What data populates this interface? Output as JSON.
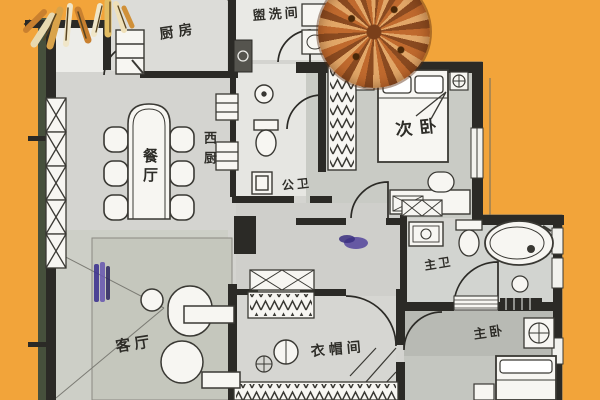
{
  "meta": {
    "type": "hand-drawn apartment floor plan"
  },
  "colors": {
    "background": "#F2A43A",
    "wall": "#2B2A26",
    "wall_shadow": "#46503C",
    "floor": "#D4D4D0",
    "floor_dark": "#C2C4BE",
    "fixture": "#F7F6F2",
    "line": "#3A3934",
    "tree_dark": "#8A4A20",
    "tree_mid": "#C06A2E",
    "tree_light": "#E2A768",
    "purple": "#5A4B9E",
    "label": "#2E2D28"
  },
  "rooms": {
    "kitchen": {
      "label": "厨房"
    },
    "laundry": {
      "label": "盥洗间"
    },
    "second_bedroom": {
      "label": "次卧"
    },
    "dining": {
      "label": "餐厅"
    },
    "west_kitchen": {
      "label": "西厨"
    },
    "public_bath": {
      "label": "公卫"
    },
    "master_bath": {
      "label": "主卫"
    },
    "living": {
      "label": "客厅"
    },
    "cloakroom": {
      "label": "衣帽间"
    },
    "master_bedroom": {
      "label": "主卧"
    }
  }
}
